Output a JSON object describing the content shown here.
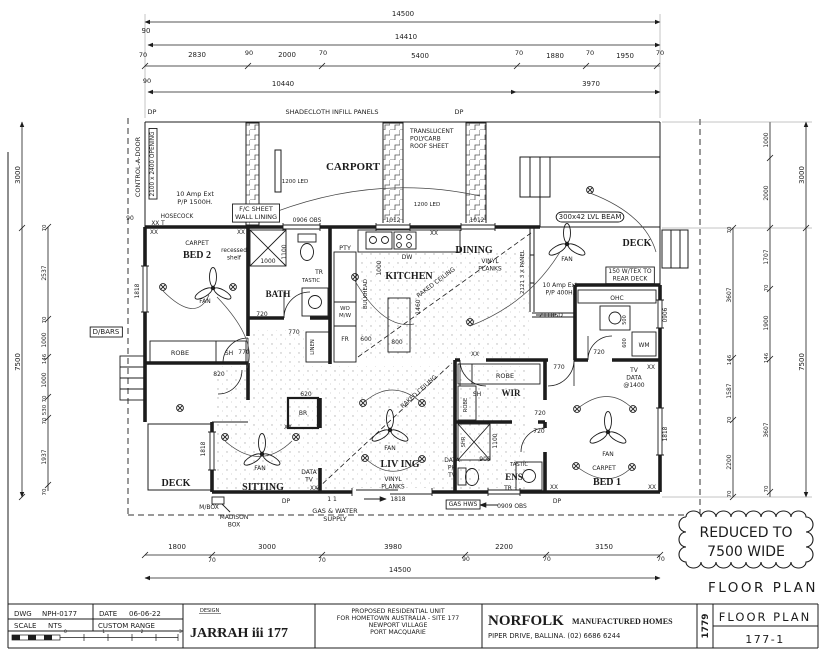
{
  "page": {
    "bg": "#ffffff",
    "ink": "#1c1c1c"
  },
  "notes": {
    "reduced_line1": "REDUCED TO",
    "reduced_line2": "7500 WIDE",
    "plan_caption": "FLOOR PLAN"
  },
  "title_block": {
    "dwg_label": "DWG",
    "dwg_value": "NPH-0177",
    "date_label": "DATE",
    "date_value": "06-06-22",
    "scale_label": "SCALE",
    "scale_value": "NTS",
    "range_value": "CUSTOM RANGE",
    "scale_bar_ticks": "0 1 2 3 4 5",
    "design_label": "DESIGN",
    "design_name": "JARRAH iii 177",
    "project_line1": "PROPOSED RESIDENTIAL UNIT",
    "project_line2": "FOR HOMETOWN AUSTRALIA - SITE 177",
    "project_line3": "NEWPORT VILLAGE",
    "project_line4": "PORT MACQUARIE",
    "company_name": "NORFOLK",
    "company_type": "MANUFACTURED HOMES",
    "company_address": "PIPER DRIVE, BALLINA.  (02) 6686 6244",
    "job_number": "1779",
    "sheet_title": "FLOOR PLAN",
    "sheet_number": "177-1"
  },
  "plan": {
    "labels": [
      {
        "t": "14500",
        "x": 403,
        "y": 16,
        "s": 7
      },
      {
        "t": "90",
        "x": 146,
        "y": 33,
        "s": 7
      },
      {
        "t": "14410",
        "x": 406,
        "y": 39,
        "s": 7
      },
      {
        "t": "70",
        "x": 143,
        "y": 57,
        "s": 6.5
      },
      {
        "t": "2830",
        "x": 197,
        "y": 57,
        "s": 7
      },
      {
        "t": "90",
        "x": 249,
        "y": 55,
        "s": 6.5
      },
      {
        "t": "2000",
        "x": 287,
        "y": 57,
        "s": 7
      },
      {
        "t": "70",
        "x": 323,
        "y": 55,
        "s": 6.5
      },
      {
        "t": "5400",
        "x": 420,
        "y": 58,
        "s": 7
      },
      {
        "t": "70",
        "x": 519,
        "y": 55,
        "s": 6.5
      },
      {
        "t": "1880",
        "x": 555,
        "y": 58,
        "s": 7
      },
      {
        "t": "70",
        "x": 590,
        "y": 55,
        "s": 6.5
      },
      {
        "t": "1950",
        "x": 625,
        "y": 58,
        "s": 7
      },
      {
        "t": "70",
        "x": 660,
        "y": 55,
        "s": 6.5
      },
      {
        "t": "90",
        "x": 147,
        "y": 83,
        "s": 6.5
      },
      {
        "t": "10440",
        "x": 283,
        "y": 86,
        "s": 7
      },
      {
        "t": "3970",
        "x": 591,
        "y": 86,
        "s": 7
      },
      {
        "t": "DP",
        "x": 152,
        "y": 114,
        "s": 6.5
      },
      {
        "t": "SHADECLOTH INFILL PANELS",
        "x": 332,
        "y": 114,
        "s": 6.5
      },
      {
        "t": "DP",
        "x": 459,
        "y": 114,
        "s": 6.5
      },
      {
        "t": "CONTROL-A-DOOR",
        "x": 140,
        "y": 167,
        "s": 6.5,
        "r": -90
      },
      {
        "t": "2100 x 2400 OPENING",
        "x": 154,
        "y": 164,
        "s": 5.8,
        "r": -90,
        "box": 1
      },
      {
        "t": "CARPORT",
        "x": 353,
        "y": 170,
        "s": 11,
        "f": "serif",
        "b": 1
      },
      {
        "t": "1200 LED",
        "x": 295,
        "y": 183,
        "s": 5.5
      },
      {
        "t": "1200 LED",
        "x": 427,
        "y": 206,
        "s": 5.5
      },
      {
        "t": [
          "TRANSLUCENT",
          "POLYCARB",
          "ROOF SHEET"
        ],
        "x": 410,
        "y": 133,
        "s": 6,
        "a": "s"
      },
      {
        "t": [
          "10 Amp Ext",
          "P/P 1500H."
        ],
        "x": 195,
        "y": 196,
        "s": 6.5
      },
      {
        "t": [
          "F/C SHEET",
          "WALL LINING"
        ],
        "x": 256,
        "y": 211,
        "s": 6.5,
        "box": 1
      },
      {
        "t": "HOSECOCK",
        "x": 177,
        "y": 218,
        "s": 5.8
      },
      {
        "t": "90",
        "x": 130,
        "y": 220,
        "s": 6
      },
      {
        "t": "XX T",
        "x": 158,
        "y": 225,
        "s": 5.8
      },
      {
        "t": "0906 OBS",
        "x": 307,
        "y": 222,
        "s": 5.8
      },
      {
        "t": "1012",
        "x": 393,
        "y": 222,
        "s": 5.8
      },
      {
        "t": "1012",
        "x": 477,
        "y": 222,
        "s": 5.8
      },
      {
        "t": "300x42 LVL BEAM",
        "x": 590,
        "y": 219,
        "s": 7,
        "box": 1,
        "rx": 6
      },
      {
        "t": "DECK",
        "x": 637,
        "y": 246,
        "s": 10,
        "f": "serif",
        "b": 1
      },
      {
        "t": [
          "150 W/TEX TO",
          "REAR DECK"
        ],
        "x": 630,
        "y": 273,
        "s": 6,
        "box": 1
      },
      {
        "t": "FAN",
        "x": 205,
        "y": 303,
        "s": 6
      },
      {
        "t": "FAN",
        "x": 567,
        "y": 261,
        "s": 6
      },
      {
        "t": "FAN",
        "x": 390,
        "y": 450,
        "s": 6
      },
      {
        "t": "FAN",
        "x": 260,
        "y": 470,
        "s": 6
      },
      {
        "t": "FAN",
        "x": 608,
        "y": 456,
        "s": 6
      },
      {
        "t": "3000",
        "x": 20,
        "y": 175,
        "s": 7,
        "r": -90
      },
      {
        "t": "7500",
        "x": 20,
        "y": 362,
        "s": 7,
        "r": -90
      },
      {
        "t": "70",
        "x": 46,
        "y": 228,
        "s": 5.5,
        "r": -90
      },
      {
        "t": "2537",
        "x": 46,
        "y": 273,
        "s": 6,
        "r": -90
      },
      {
        "t": "70",
        "x": 46,
        "y": 320,
        "s": 5.5,
        "r": -90
      },
      {
        "t": "1000",
        "x": 46,
        "y": 340,
        "s": 6,
        "r": -90
      },
      {
        "t": "146",
        "x": 46,
        "y": 359,
        "s": 5.5,
        "r": -90
      },
      {
        "t": "1000",
        "x": 46,
        "y": 380,
        "s": 6,
        "r": -90
      },
      {
        "t": "70",
        "x": 46,
        "y": 399,
        "s": 5.5,
        "r": -90
      },
      {
        "t": "530",
        "x": 46,
        "y": 410,
        "s": 5.5,
        "r": -90
      },
      {
        "t": "70",
        "x": 46,
        "y": 421,
        "s": 5.5,
        "r": -90
      },
      {
        "t": "1937",
        "x": 46,
        "y": 457,
        "s": 6,
        "r": -90
      },
      {
        "t": "70",
        "x": 46,
        "y": 492,
        "s": 5.5,
        "r": -90
      },
      {
        "t": "D/BARS",
        "x": 106,
        "y": 334,
        "s": 7,
        "box": 1
      },
      {
        "t": "70",
        "x": 731,
        "y": 230,
        "s": 5.5,
        "r": -90
      },
      {
        "t": "3607",
        "x": 731,
        "y": 295,
        "s": 6,
        "r": -90
      },
      {
        "t": "146",
        "x": 731,
        "y": 360,
        "s": 5.5,
        "r": -90
      },
      {
        "t": "1587",
        "x": 731,
        "y": 391,
        "s": 6,
        "r": -90
      },
      {
        "t": "70",
        "x": 731,
        "y": 420,
        "s": 5.5,
        "r": -90
      },
      {
        "t": "2200",
        "x": 731,
        "y": 462,
        "s": 6,
        "r": -90
      },
      {
        "t": "70",
        "x": 731,
        "y": 494,
        "s": 5.5,
        "r": -90
      },
      {
        "t": "1000",
        "x": 768,
        "y": 140,
        "s": 6,
        "r": -90
      },
      {
        "t": "2000",
        "x": 768,
        "y": 193,
        "s": 6,
        "r": -90
      },
      {
        "t": "1707",
        "x": 768,
        "y": 257,
        "s": 6,
        "r": -90
      },
      {
        "t": "70",
        "x": 768,
        "y": 288,
        "s": 5.5,
        "r": -90
      },
      {
        "t": "1900",
        "x": 768,
        "y": 323,
        "s": 6,
        "r": -90
      },
      {
        "t": "146",
        "x": 768,
        "y": 358,
        "s": 5.5,
        "r": -90
      },
      {
        "t": "3607",
        "x": 768,
        "y": 430,
        "s": 6,
        "r": -90
      },
      {
        "t": "70",
        "x": 768,
        "y": 489,
        "s": 5.5,
        "r": -90
      },
      {
        "t": "3000",
        "x": 804,
        "y": 175,
        "s": 7,
        "r": -90
      },
      {
        "t": "7500",
        "x": 804,
        "y": 362,
        "s": 7,
        "r": -90
      },
      {
        "t": "XX",
        "x": 154,
        "y": 234,
        "s": 5.8
      },
      {
        "t": "XX",
        "x": 241,
        "y": 234,
        "s": 5.8
      },
      {
        "t": "XX",
        "x": 434,
        "y": 235,
        "s": 5.8
      },
      {
        "t": "CARPET",
        "x": 197,
        "y": 245,
        "s": 6
      },
      {
        "t": "BED 2",
        "x": 197,
        "y": 258,
        "s": 10,
        "f": "serif",
        "b": 1
      },
      {
        "t": [
          "recessed",
          "shelf"
        ],
        "x": 234,
        "y": 252,
        "s": 5.8
      },
      {
        "t": "1818",
        "x": 139,
        "y": 291,
        "s": 5.8,
        "r": -90
      },
      {
        "t": "ROBE",
        "x": 180,
        "y": 355,
        "s": 6.5
      },
      {
        "t": "SH",
        "x": 229,
        "y": 355,
        "s": 6
      },
      {
        "t": "770",
        "x": 244,
        "y": 354,
        "s": 6
      },
      {
        "t": "820",
        "x": 219,
        "y": 376,
        "s": 6
      },
      {
        "t": "1000",
        "x": 268,
        "y": 263,
        "s": 6
      },
      {
        "t": "1100",
        "x": 286,
        "y": 252,
        "s": 6,
        "r": -90
      },
      {
        "t": "BATH",
        "x": 278,
        "y": 297,
        "s": 9,
        "f": "serif",
        "b": 1
      },
      {
        "t": "720",
        "x": 262,
        "y": 316,
        "s": 6
      },
      {
        "t": "TR",
        "x": 319,
        "y": 274,
        "s": 6
      },
      {
        "t": "TASTIC",
        "x": 311,
        "y": 282,
        "s": 5.2
      },
      {
        "t": "770",
        "x": 294,
        "y": 334,
        "s": 6
      },
      {
        "t": "LINEN",
        "x": 314,
        "y": 347,
        "s": 5.2,
        "r": -90
      },
      {
        "t": "PTY",
        "x": 345,
        "y": 250,
        "s": 6.5
      },
      {
        "t": [
          "WO",
          "M/W"
        ],
        "x": 345,
        "y": 310,
        "s": 5.5
      },
      {
        "t": "FR",
        "x": 345,
        "y": 341,
        "s": 6
      },
      {
        "t": "KITCHEN",
        "x": 409,
        "y": 279,
        "s": 10,
        "f": "serif",
        "b": 1
      },
      {
        "t": "DW",
        "x": 407,
        "y": 259,
        "s": 6
      },
      {
        "t": "1000",
        "x": 381,
        "y": 268,
        "s": 6,
        "r": -90
      },
      {
        "t": "BULKHEAD",
        "x": 367,
        "y": 294,
        "s": 5.5,
        "r": -90
      },
      {
        "t": "1460",
        "x": 420,
        "y": 307,
        "s": 6,
        "r": -90
      },
      {
        "t": "800",
        "x": 397,
        "y": 344,
        "s": 6
      },
      {
        "t": "600",
        "x": 366,
        "y": 341,
        "s": 6
      },
      {
        "t": "DINING",
        "x": 474,
        "y": 253,
        "s": 10,
        "f": "serif",
        "b": 1
      },
      {
        "t": [
          "VINYL",
          "PLANKS"
        ],
        "x": 490,
        "y": 263,
        "s": 6
      },
      {
        "t": "RAKED CEILING",
        "x": 437,
        "y": 284,
        "s": 6,
        "r": -37
      },
      {
        "t": "2121 3 X PANEL",
        "x": 524,
        "y": 272,
        "s": 5.5,
        "r": -90
      },
      {
        "t": "2118SD",
        "x": 551,
        "y": 317,
        "s": 6
      },
      {
        "t": [
          "10 Amp Ext",
          "P/P 400H."
        ],
        "x": 560,
        "y": 287,
        "s": 6
      },
      {
        "t": "XX",
        "x": 475,
        "y": 356,
        "s": 5.8
      },
      {
        "t": "OHC",
        "x": 617,
        "y": 300,
        "s": 6
      },
      {
        "t": "500",
        "x": 626,
        "y": 320,
        "s": 5,
        "r": -90
      },
      {
        "t": "600",
        "x": 626,
        "y": 343,
        "s": 5,
        "r": -90
      },
      {
        "t": "WM",
        "x": 644,
        "y": 347,
        "s": 6
      },
      {
        "t": "720",
        "x": 599,
        "y": 354,
        "s": 6
      },
      {
        "t": "0906",
        "x": 667,
        "y": 315,
        "s": 5.8,
        "r": -90
      },
      {
        "t": [
          "TV",
          "DATA",
          "@1400"
        ],
        "x": 634,
        "y": 372,
        "s": 6
      },
      {
        "t": "XX",
        "x": 651,
        "y": 369,
        "s": 5.8
      },
      {
        "t": "ROBE",
        "x": 505,
        "y": 378,
        "s": 6.5
      },
      {
        "t": "770",
        "x": 559,
        "y": 369,
        "s": 6
      },
      {
        "t": "SH",
        "x": 477,
        "y": 396,
        "s": 6
      },
      {
        "t": "WIR",
        "x": 511,
        "y": 396,
        "s": 9,
        "f": "serif",
        "b": 1
      },
      {
        "t": "ROBE",
        "x": 467,
        "y": 405,
        "s": 5.2,
        "r": -90
      },
      {
        "t": "720",
        "x": 540,
        "y": 415,
        "s": 6
      },
      {
        "t": "720",
        "x": 539,
        "y": 433,
        "s": 6
      },
      {
        "t": "SHR",
        "x": 465,
        "y": 442,
        "s": 5.2,
        "r": -90
      },
      {
        "t": "1100",
        "x": 497,
        "y": 441,
        "s": 6,
        "r": -90
      },
      {
        "t": "900",
        "x": 485,
        "y": 461,
        "s": 6
      },
      {
        "t": "TASTIC",
        "x": 519,
        "y": 466,
        "s": 5.2
      },
      {
        "t": "ENS",
        "x": 514,
        "y": 480,
        "s": 9,
        "f": "serif",
        "b": 1
      },
      {
        "t": "TR",
        "x": 508,
        "y": 490,
        "s": 6
      },
      {
        "t": [
          "DATA",
          "PH",
          "TV"
        ],
        "x": 452,
        "y": 462,
        "s": 6
      },
      {
        "t": "GAS HWS",
        "x": 463,
        "y": 506,
        "s": 6,
        "box": 1
      },
      {
        "t": "0909 OBS",
        "x": 512,
        "y": 508,
        "s": 6
      },
      {
        "t": "DP",
        "x": 557,
        "y": 503,
        "s": 6
      },
      {
        "t": "CARPET",
        "x": 604,
        "y": 470,
        "s": 6
      },
      {
        "t": "BED 1",
        "x": 607,
        "y": 485,
        "s": 10,
        "f": "serif",
        "b": 1
      },
      {
        "t": "1818",
        "x": 667,
        "y": 434,
        "s": 5.8,
        "r": -90
      },
      {
        "t": "XX",
        "x": 554,
        "y": 489,
        "s": 5.8
      },
      {
        "t": "XX",
        "x": 652,
        "y": 489,
        "s": 5.8
      },
      {
        "t": "620",
        "x": 306,
        "y": 396,
        "s": 6
      },
      {
        "t": "BR",
        "x": 303,
        "y": 415,
        "s": 6
      },
      {
        "t": "XX",
        "x": 288,
        "y": 429,
        "s": 5.8
      },
      {
        "t": "LIV ING",
        "x": 400,
        "y": 467,
        "s": 10,
        "f": "serif",
        "b": 1
      },
      {
        "t": [
          "VINYL",
          "PLANKS"
        ],
        "x": 393,
        "y": 481,
        "s": 6
      },
      {
        "t": "RAKED CEILING",
        "x": 420,
        "y": 393,
        "s": 6,
        "r": -42
      },
      {
        "t": [
          "DATA",
          "TV"
        ],
        "x": 309,
        "y": 474,
        "s": 6
      },
      {
        "t": "XX",
        "x": 314,
        "y": 490,
        "s": 5.8
      },
      {
        "t": "1818",
        "x": 398,
        "y": 501,
        "s": 6
      },
      {
        "t": "DECK",
        "x": 176,
        "y": 486,
        "s": 10,
        "f": "serif",
        "b": 1
      },
      {
        "t": "SITTING",
        "x": 263,
        "y": 490,
        "s": 10,
        "f": "serif",
        "b": 1
      },
      {
        "t": "1818",
        "x": 205,
        "y": 449,
        "s": 5.8,
        "r": -90
      },
      {
        "t": "M/BOX",
        "x": 209,
        "y": 509,
        "s": 6
      },
      {
        "t": [
          "MADISON",
          "BOX"
        ],
        "x": 234,
        "y": 519,
        "s": 6
      },
      {
        "t": "DP",
        "x": 286,
        "y": 503,
        "s": 6
      },
      {
        "t": "1 1",
        "x": 332,
        "y": 501,
        "s": 6
      },
      {
        "t": [
          "GAS & WATER",
          "SUPPLY"
        ],
        "x": 335,
        "y": 513,
        "s": 6.5
      },
      {
        "t": "1800",
        "x": 177,
        "y": 549,
        "s": 7
      },
      {
        "t": "70",
        "x": 212,
        "y": 562,
        "s": 6
      },
      {
        "t": "3000",
        "x": 267,
        "y": 549,
        "s": 7
      },
      {
        "t": "70",
        "x": 322,
        "y": 562,
        "s": 6
      },
      {
        "t": "3980",
        "x": 393,
        "y": 549,
        "s": 7
      },
      {
        "t": "90",
        "x": 466,
        "y": 561,
        "s": 6
      },
      {
        "t": "2200",
        "x": 504,
        "y": 549,
        "s": 7
      },
      {
        "t": "70",
        "x": 547,
        "y": 561,
        "s": 6
      },
      {
        "t": "3150",
        "x": 604,
        "y": 549,
        "s": 7
      },
      {
        "t": "70",
        "x": 661,
        "y": 561,
        "s": 6
      },
      {
        "t": "14500",
        "x": 400,
        "y": 572,
        "s": 7
      }
    ]
  }
}
